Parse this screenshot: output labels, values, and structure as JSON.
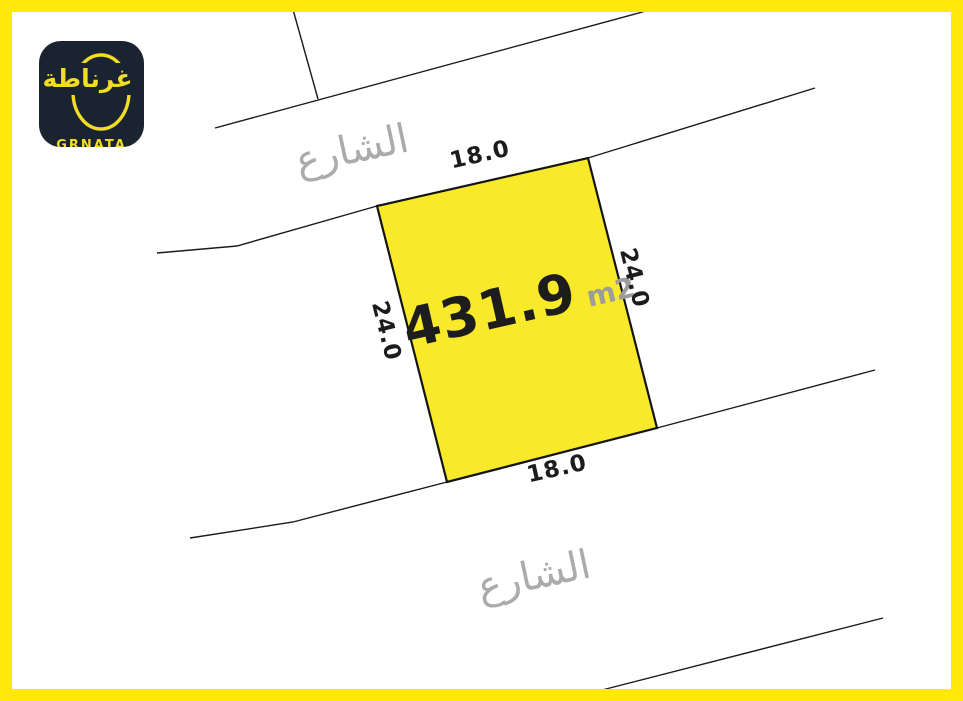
{
  "page": {
    "background_color": "#FFFFFF",
    "frame_color": "#FFE90A"
  },
  "logo": {
    "arabic_name": "غرناطة",
    "latin_name": "GRNATA",
    "background_color": "#1A2330",
    "accent_color": "#F2DC26"
  },
  "plot": {
    "area_value": "431.9",
    "area_unit": "m2",
    "fill_color": "#F8EA2B",
    "border_color": "#141414",
    "dimensions": {
      "top": "18.0",
      "right": "24.0",
      "bottom": "18.0",
      "left": "24.0"
    }
  },
  "streets": {
    "top_label": "الشارع",
    "bottom_label": "الشارع",
    "label_color": "#ABABAB",
    "line_color": "#1b1b1b"
  }
}
